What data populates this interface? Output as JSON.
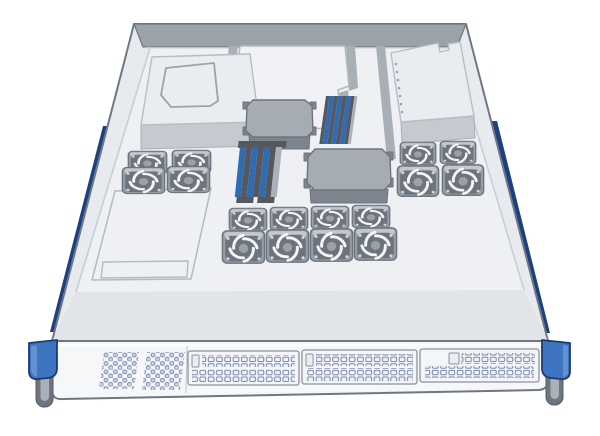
{
  "image": {
    "title": "1U rackmount server with top cover removed, internal components visible",
    "style": "isometric product illustration",
    "background": "#ffffff"
  },
  "colors": {
    "background": "#ffffff",
    "chassis_outline": "#6f7781",
    "wall_light": "#e7eaee",
    "wall_shade": "#c9ced4",
    "rim_dark": "#9ba2aa",
    "floor": "#eef0f3",
    "floor_front": "#e1e4e8",
    "panel_white": "#f6f7f9",
    "divider": "#a9afb7",
    "plate_light": "#f0f2f5",
    "psu_top": "#eaedf0",
    "psu_side": "#c5cad1",
    "hs_top": "#a6acb4",
    "hs_side": "#7e848d",
    "hs_edge": "#6d747d",
    "fan_body": "#969ca4",
    "fan_top": "#c3c8ce",
    "fan_dark": "#6e747d",
    "fan_hub": "#9aa1a9",
    "fan_blade": "#f3f5f7",
    "dimm_blue": "#2f6cb4",
    "dimm_dark": "#56585d",
    "dimm_light": "#abb1b9",
    "rail_navy": "#1d4080",
    "rail_blue": "#3b71b9",
    "ear_blue": "#3f74c0",
    "ear_navy": "#1c3b70",
    "screw_dark": "#6f757e",
    "screw_light": "#abb1b8",
    "perf_stroke": "#66789f",
    "perf_fill": "#ccd5e5",
    "mesh_fill": "#eef1f6",
    "bay_fill": "#f3f5f8",
    "bay_stroke": "#8c939c",
    "seam": "#c7ccd2"
  },
  "components": {
    "chassis": {
      "name": "1U rackmount server chassis",
      "cover": "removed"
    },
    "rails": {
      "count": 2,
      "positions": [
        "left",
        "right"
      ],
      "color": "navy blue"
    },
    "rack_ears": {
      "count": 2,
      "thumbscrews": 2,
      "color": "blue"
    },
    "rear_wall": {
      "name": "rear chassis wall"
    },
    "power_supply_left": {
      "name": "rear-left module with cutout outline"
    },
    "power_supply_right": {
      "name": "rear-right power supply with vent dots and corner notch"
    },
    "air_shroud": {
      "name": "center air shroud plate with gray channel dividers"
    },
    "heatsinks": {
      "count": 2
    },
    "memory_banks": {
      "count": 2,
      "slats_per_bank": 7,
      "slat_colors": [
        "blue",
        "dark-gray"
      ]
    },
    "fan_groups": [
      {
        "id": "left",
        "rows": 2,
        "cols": 2,
        "fans": 4
      },
      {
        "id": "right",
        "rows": 2,
        "cols": 2,
        "fans": 4
      },
      {
        "id": "center",
        "rows": 2,
        "cols": 4,
        "fans": 8
      }
    ],
    "fans_total": 16,
    "drive_tray": {
      "name": "front-left flat tray cover with slot"
    },
    "front_panel": {
      "vent_patches": 2,
      "drive_bays": 3,
      "bay_latches": 3
    }
  }
}
